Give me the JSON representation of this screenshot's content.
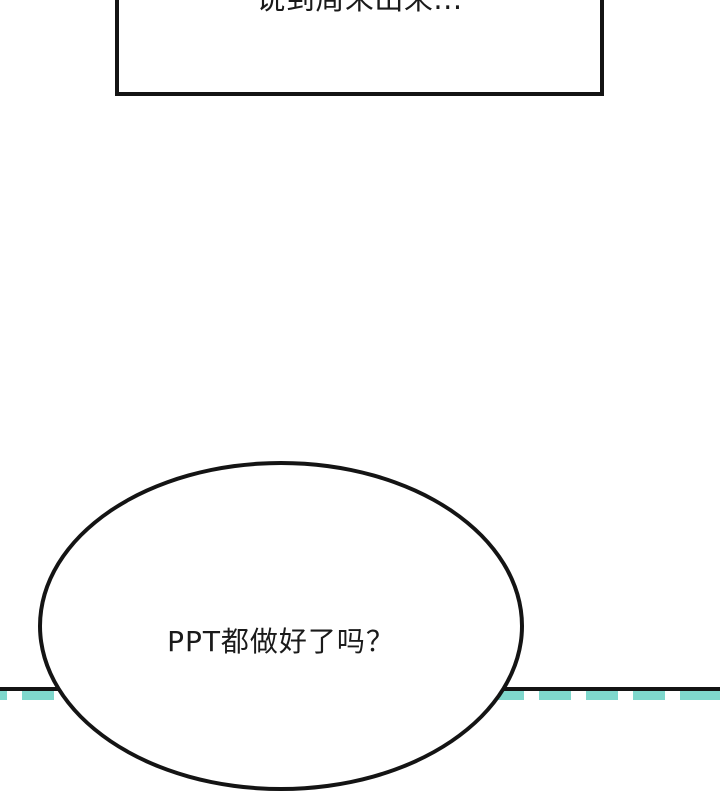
{
  "panel": {
    "type": "comic-panel",
    "background_color": "#ffffff",
    "line_color": "#141414"
  },
  "speech_box": {
    "text": "说到周末出来..."
  },
  "speech_bubble": {
    "text": "PPT都做好了吗？"
  },
  "bottom_stripe_band": {
    "description": "striped-edge-decoration",
    "stripe_teal": "#7fd8cd",
    "stripe_white": "#ffffff"
  }
}
